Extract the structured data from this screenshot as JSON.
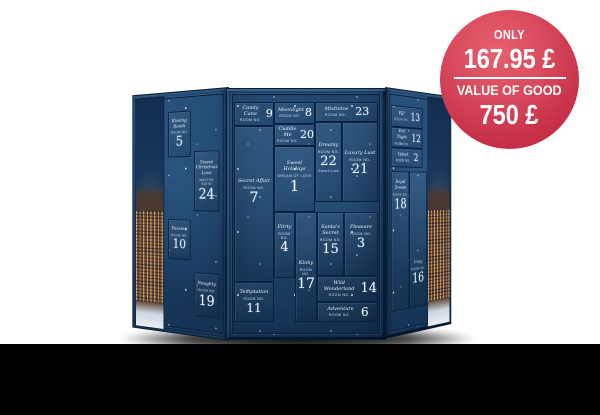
{
  "page": {
    "background": "#ffffff",
    "bottom_bar_color": "#000000"
  },
  "badge": {
    "eyebrow": "ONLY",
    "price": "167.95 £",
    "value_label": "VALUE OF GOOD",
    "value": "750 £",
    "bg_color_start": "#e6616f",
    "bg_color_end": "#bb2740",
    "text_color": "#ffffff"
  },
  "calendar": {
    "room_no_label": "Room No.",
    "colors": {
      "panel_navy": "#1b3f67",
      "door_line": "#0a2241",
      "text": "#e9f2fb",
      "bevel": "#33618d"
    },
    "panels": {
      "left": {
        "doors": [
          {
            "number": "5",
            "name": "Kissing Booth"
          },
          {
            "number": "24",
            "name": "Sweet Christmas Love",
            "suite": "Master Suite"
          },
          {
            "number": "10",
            "name": "Passion"
          },
          {
            "number": "19",
            "name": "Naughty"
          }
        ]
      },
      "center": {
        "doors": [
          {
            "number": "9",
            "name": "Candy Cane"
          },
          {
            "number": "8",
            "name": "Moonlight"
          },
          {
            "number": "23",
            "name": "Mistletoe"
          },
          {
            "number": "20",
            "name": "Cuddle Me"
          },
          {
            "number": "22",
            "name": "Dreamy",
            "extra": "Sweet Love"
          },
          {
            "number": "21",
            "name": "Luxury Lust"
          },
          {
            "number": "1",
            "name": "Sweet Holidays",
            "sub": "Dream of Love"
          },
          {
            "number": "7",
            "name": "Secret Affair"
          },
          {
            "number": "4",
            "name": "Flirty"
          },
          {
            "number": "17",
            "name": "Kinky"
          },
          {
            "number": "15",
            "name": "Santa's Secret"
          },
          {
            "number": "3",
            "name": "Pleasure"
          },
          {
            "number": "14",
            "name": "Wild Wonderland"
          },
          {
            "number": "6",
            "name": "Adventure"
          },
          {
            "number": "11",
            "name": "Temptation"
          }
        ]
      },
      "right": {
        "doors": [
          {
            "number": "13",
            "name": "VIP"
          },
          {
            "number": "12",
            "name": "Hot Night"
          },
          {
            "number": "2",
            "name": "Velvet"
          },
          {
            "number": "18",
            "name": "Royal Dream"
          },
          {
            "number": "16",
            "name": "Cozy"
          }
        ]
      }
    }
  }
}
